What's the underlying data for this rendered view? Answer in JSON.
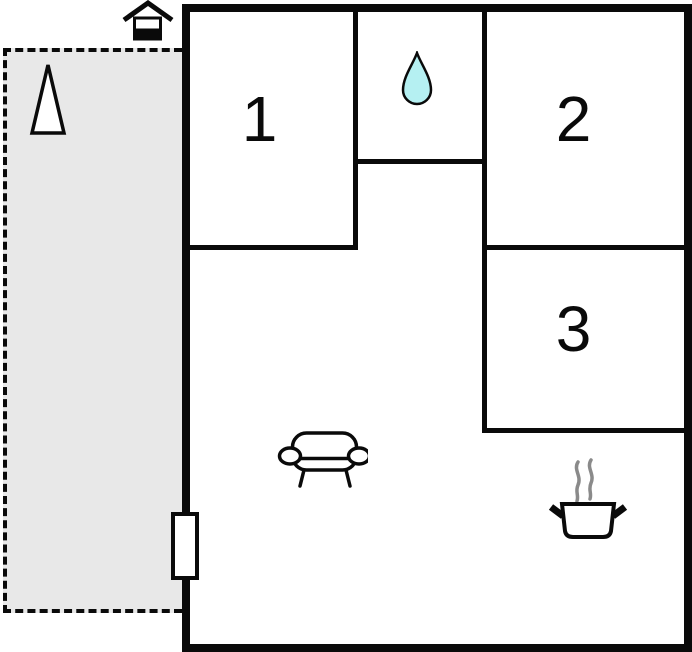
{
  "diagram": {
    "type": "floor-plan",
    "rooms": [
      {
        "name": "room-1",
        "label": "1"
      },
      {
        "name": "room-2",
        "label": "2"
      },
      {
        "name": "room-3",
        "label": "3"
      }
    ],
    "features": [
      {
        "name": "bathroom",
        "icon": "water-drop-icon"
      },
      {
        "name": "living-area",
        "icon": "sofa-icon"
      },
      {
        "name": "kitchen",
        "icon": "cooking-pot-icon"
      },
      {
        "name": "terrace",
        "icon": "tree-icon"
      },
      {
        "name": "annex",
        "icon": "house-icon"
      },
      {
        "name": "entrance",
        "icon": "door"
      }
    ],
    "colors": {
      "wall": "#0a0a0a",
      "background": "#ffffff",
      "terrace_fill": "#e8e8e8",
      "water_drop_fill": "#b5f0f2",
      "steam": "#8a8a8a"
    }
  }
}
